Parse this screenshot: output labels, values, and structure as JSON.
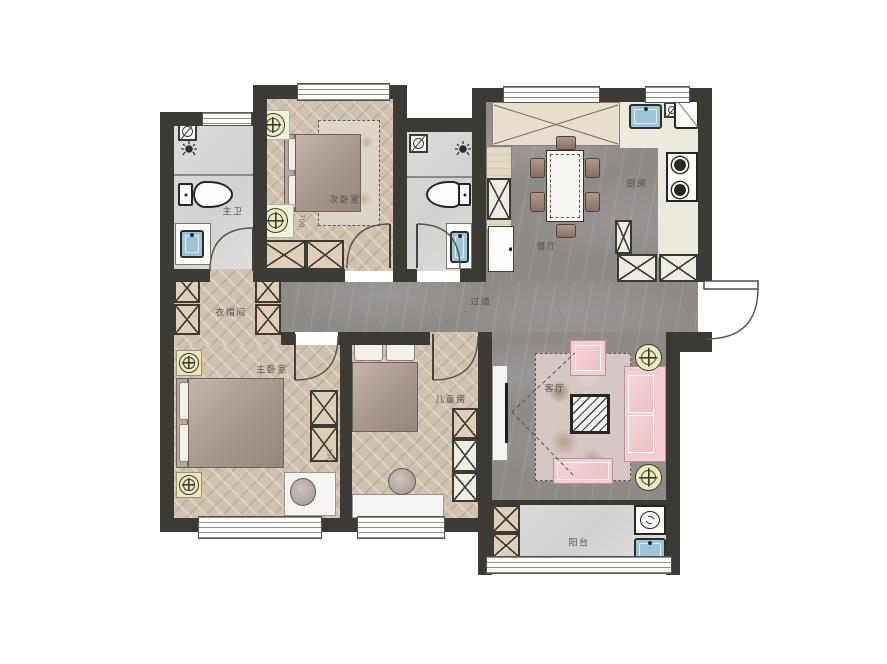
{
  "rooms": {
    "master_bath": {
      "label": "主卫"
    },
    "second_bedroom": {
      "label": "次卧室"
    },
    "dining_room": {
      "label": "餐厅"
    },
    "kitchen": {
      "label": "厨房"
    },
    "hallway": {
      "label": "过道"
    },
    "cloakroom": {
      "label": "衣帽间"
    },
    "master_bedroom": {
      "label": "主卧室"
    },
    "kids_room": {
      "label": "儿童房"
    },
    "living_room": {
      "label": "客厅"
    },
    "balcony": {
      "label": "阳台"
    }
  },
  "dimensions": {
    "secondary_nightstand": "700",
    "master_wardrobe": "150"
  },
  "colors": {
    "wall": "#3b3a35",
    "wood_floor": "#d0c2ae",
    "stone_floor": "#8d8a88",
    "bath_floor": "#d8d7d5",
    "counter": "#eceade",
    "bed_fabric": "#ab988f",
    "sofa_pink": "#f4cdd1",
    "sink_blue": "#9dc5d8",
    "lamp_yellow": "#ebebbc"
  },
  "icons": {
    "lamp": "ceiling-lamp",
    "fan": "exhaust-fan",
    "shower": "shower-head",
    "washer": "washing-machine"
  }
}
